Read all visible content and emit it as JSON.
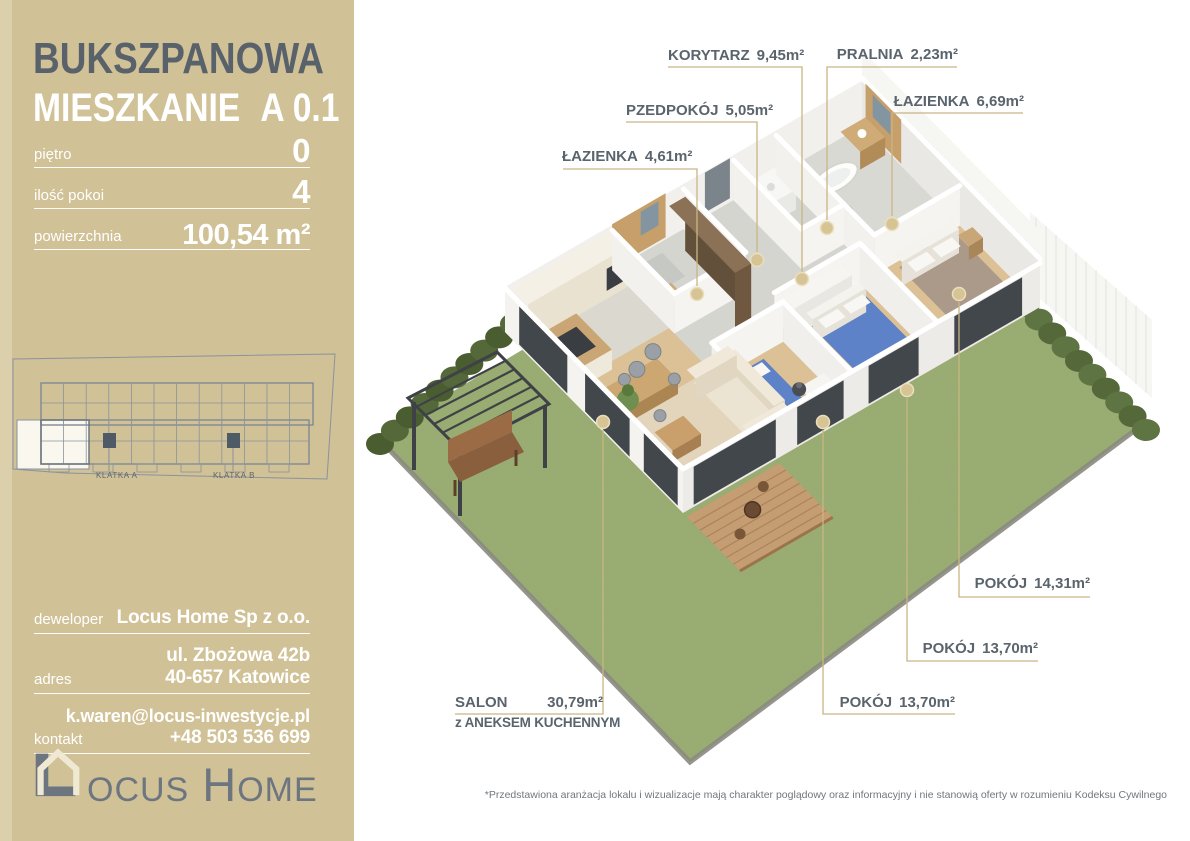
{
  "sidebar": {
    "project_title": "BUKSZPANOWA",
    "unit_label": "MIESZKANIE",
    "unit_number": "A 0.1",
    "stats": [
      {
        "label": "piętro",
        "value": "0"
      },
      {
        "label": "ilość pokoi",
        "value": "4"
      },
      {
        "label": "powierzchnia",
        "value": "100,54 m²"
      }
    ],
    "minimap": {
      "klatka_a": "KLATKA A",
      "klatka_b": "KLATKA B"
    },
    "developer": [
      {
        "label": "deweloper",
        "lines": [
          "Locus Home Sp z o.o."
        ]
      },
      {
        "label": "adres",
        "lines": [
          "ul. Zbożowa 42b",
          "40-657 Katowice"
        ]
      },
      {
        "label": "kontakt",
        "lines": [
          "k.waren@locus-inwestycje.pl",
          "+48 503 536 699"
        ]
      }
    ],
    "logo": {
      "l1": "L",
      "rest1": "OCUS",
      "l2": "H",
      "rest2": "OME"
    }
  },
  "plan": {
    "rooms": [
      {
        "id": "korytarz",
        "name": "KORYTARZ",
        "area": "9,45m²"
      },
      {
        "id": "pralnia",
        "name": "PRALNIA",
        "area": "2,23m²"
      },
      {
        "id": "lazienka-gorna",
        "name": "ŁAZIENKA",
        "area": "6,69m²"
      },
      {
        "id": "przedpokoj",
        "name": "PZEDPOKÓJ",
        "area": "5,05m²"
      },
      {
        "id": "lazienka-dolna",
        "name": "ŁAZIENKA",
        "area": "4,61m²"
      },
      {
        "id": "pokoj-1",
        "name": "POKÓJ",
        "area": "14,31m²"
      },
      {
        "id": "pokoj-2",
        "name": "POKÓJ",
        "area": "13,70m²"
      },
      {
        "id": "pokoj-3",
        "name": "POKÓJ",
        "area": "13,70m²"
      },
      {
        "id": "salon",
        "name": "SALON",
        "area": "30,79m²",
        "sub": "z ANEKSEM KUCHENNYM"
      }
    ]
  },
  "footer": {
    "disclaimer": "*Przedstawiona aranżacja lokalu i wizualizacje mają charakter poglądowy oraz informacyjny i nie stanowią oferty w rozumieniu Kodeksu Cywilnego"
  },
  "colors": {
    "accent_tan": "#d0c196",
    "title_dark": "#59626b",
    "label_text": "#5a646d",
    "leader": "#c9b583",
    "grass": "#96aa6e"
  }
}
